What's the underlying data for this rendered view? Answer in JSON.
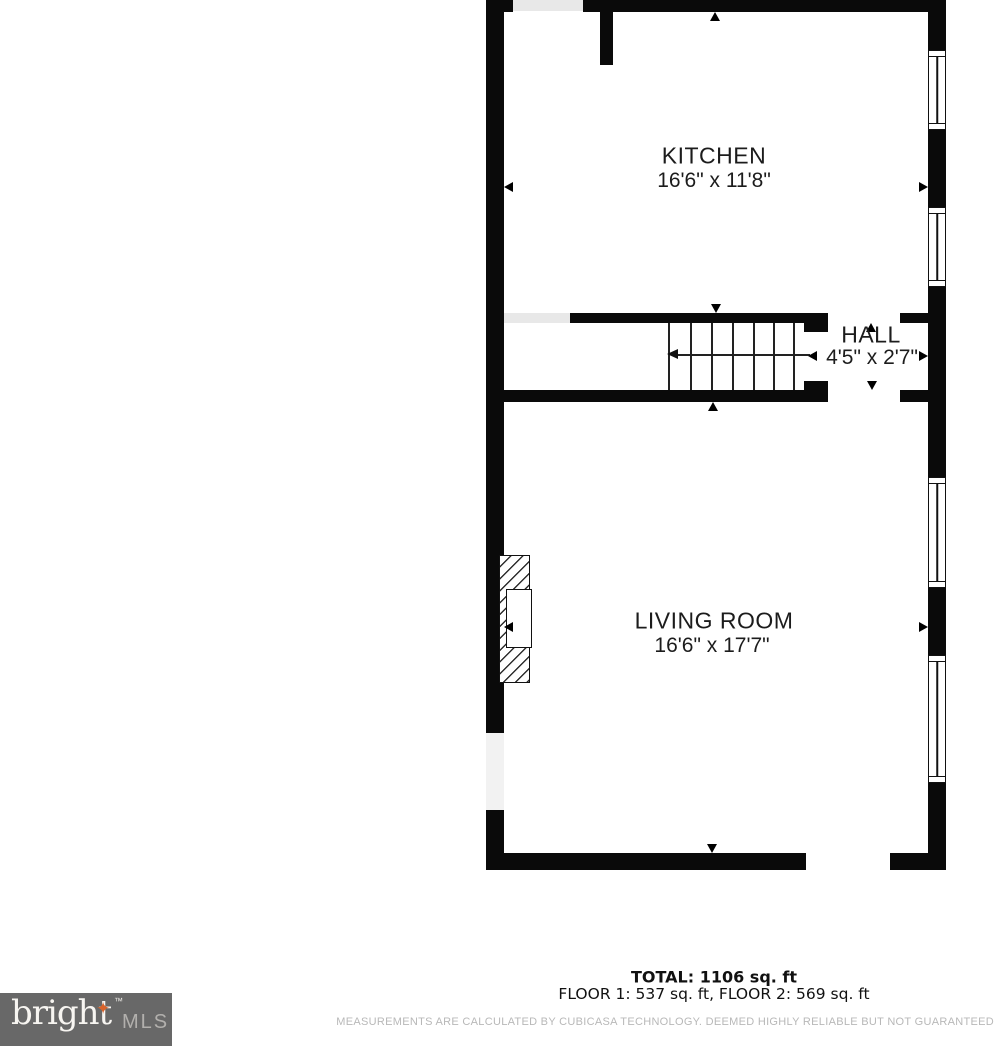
{
  "floor_plan": {
    "rooms": {
      "kitchen": {
        "name": "KITCHEN",
        "dimensions": "16'6\" x 11'8\""
      },
      "hall": {
        "name": "HALL",
        "dimensions": "4'5\" x 2'7\""
      },
      "living_room": {
        "name": "LIVING ROOM",
        "dimensions": "16'6\" x 17'7\""
      }
    }
  },
  "summary": {
    "total": "TOTAL: 1106 sq. ft",
    "floors": "FLOOR 1: 537 sq. ft, FLOOR 2: 569 sq. ft"
  },
  "disclaimer": "MEASUREMENTS ARE CALCULATED BY CUBICASA TECHNOLOGY. DEEMED HIGHLY RELIABLE BUT NOT GUARANTEED",
  "logo": {
    "brand": "bright",
    "star": "✦",
    "trademark": "™",
    "suffix": "MLS"
  },
  "colors": {
    "wall": "#0a0a0a",
    "label_text": "#1c1c1c",
    "threshold": "#e8e8e8",
    "disclaimer_text": "#b8b8b8",
    "logo_background": "#686868",
    "logo_brand": "#f7f5f1",
    "logo_star": "#d9632a",
    "logo_suffix": "#b2b0ad"
  }
}
